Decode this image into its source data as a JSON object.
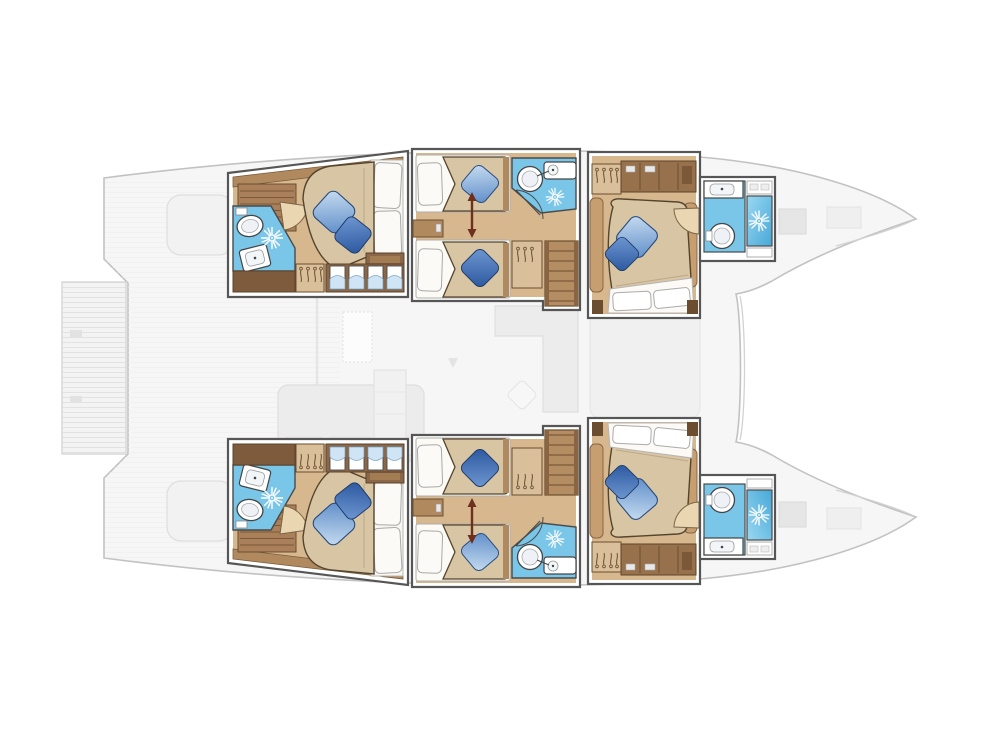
{
  "plan": {
    "vessel_type": "catamaran",
    "view": "overhead floor plan",
    "canvas": {
      "width": 1004,
      "height": 753
    },
    "hulls": [
      {
        "id": "port-hull",
        "side": "top",
        "bow": "right",
        "stern": "left"
      },
      {
        "id": "starboard-hull",
        "side": "bottom",
        "bow": "right",
        "stern": "left"
      }
    ],
    "cabins": [
      {
        "id": "cabin-aft-port",
        "hull": "port",
        "position": "aft",
        "berth": "double",
        "blue_pillows": 2,
        "bathroom": {
          "toilet": true,
          "sink": true,
          "shower_spray": true
        },
        "storage": [
          "companionway-steps",
          "hanging-locker",
          "locker-panes",
          "bench"
        ]
      },
      {
        "id": "cabin-mid-port",
        "hull": "port",
        "position": "midship",
        "berth": "twin-convertible",
        "blue_pillows": 2,
        "conversion_arrow": true,
        "bathroom": {
          "toilet": true,
          "sink": true,
          "shower_spray": true
        },
        "storage": [
          "hanging-locker",
          "nightstand"
        ],
        "stairs_to_saloon": true
      },
      {
        "id": "cabin-forward-port",
        "hull": "port",
        "position": "forward",
        "berth": "double",
        "blue_pillows": 2,
        "bathroom": {
          "toilet": true,
          "sink": true,
          "shower_stall": true,
          "shelf": true
        },
        "storage": [
          "hanging-locker",
          "shelf-unit",
          "side-ledges"
        ]
      },
      {
        "id": "cabin-aft-starboard",
        "hull": "starboard",
        "position": "aft",
        "berth": "double",
        "blue_pillows": 2,
        "bathroom": {
          "toilet": true,
          "sink": true,
          "shower_spray": true
        },
        "storage": [
          "companionway-steps",
          "hanging-locker",
          "locker-panes",
          "bench"
        ],
        "mirrored_of": "cabin-aft-port"
      },
      {
        "id": "cabin-mid-starboard",
        "hull": "starboard",
        "position": "midship",
        "berth": "twin-convertible",
        "blue_pillows": 2,
        "conversion_arrow": true,
        "bathroom": {
          "toilet": true,
          "sink": true,
          "shower_spray": true
        },
        "storage": [
          "hanging-locker",
          "nightstand"
        ],
        "stairs_to_saloon": true,
        "mirrored_of": "cabin-mid-port"
      },
      {
        "id": "cabin-forward-starboard",
        "hull": "starboard",
        "position": "forward",
        "berth": "double",
        "blue_pillows": 2,
        "bathroom": {
          "toilet": true,
          "sink": true,
          "shower_stall": true,
          "shelf": true
        },
        "storage": [
          "hanging-locker",
          "shelf-unit",
          "side-ledges"
        ],
        "mirrored_of": "cabin-forward-port"
      }
    ],
    "deck_ghost_elements": [
      "swim-platform",
      "stern-bench-port",
      "stern-bench-starboard",
      "cockpit-sofa",
      "cockpit-table",
      "galley-block",
      "saloon-sofa",
      "ottoman-pillow",
      "sunpad",
      "bow-hatches-port",
      "bow-hatches-starboard",
      "mast-step",
      "cockpit-saloon-divider"
    ]
  },
  "colors": {
    "wall": "#565656",
    "hull_line": "#c2c2c2",
    "hull_inner_line": "#d2d2d2",
    "ghost_fill": "#f6f6f6",
    "ghost_item": "#ececec",
    "ghost_line": "#dedede",
    "deck_stripe": "#ececec",
    "wood_floor": "#d7b88e",
    "wood_mid": "#b08a5e",
    "wood_dark": "#8a6748",
    "wood_frame": "#6b4e30",
    "wood_step": "#b48e62",
    "step_line": "#7a5838",
    "cabinet_dark": "#7d5b3c",
    "locker_tan": "#d9c09b",
    "ladder_wood": "#a9805a",
    "ledge_wood": "#c79e6f",
    "duvet": "#d8c5a4",
    "duvet_line": "#54452f",
    "duvet_crease": "#bda888",
    "linen": "#fbfaf6",
    "linen_line": "#b0b0b0",
    "bath_tile": "#79c6e8",
    "shower_top": "#9ad8f2",
    "shower_bottom": "#47a8d8",
    "pane_blue": "#cfe4f4",
    "pillow_light_a": "#c9def1",
    "pillow_light_b": "#5d8cc8",
    "pillow_dark_a": "#7099d2",
    "pillow_dark_b": "#2a569e",
    "fixture_line": "#444444",
    "fixture_fill": "#ffffff",
    "door_leaf": "#ead7b2",
    "arrow": "#6e2f1c",
    "spray": "#ffffff"
  }
}
